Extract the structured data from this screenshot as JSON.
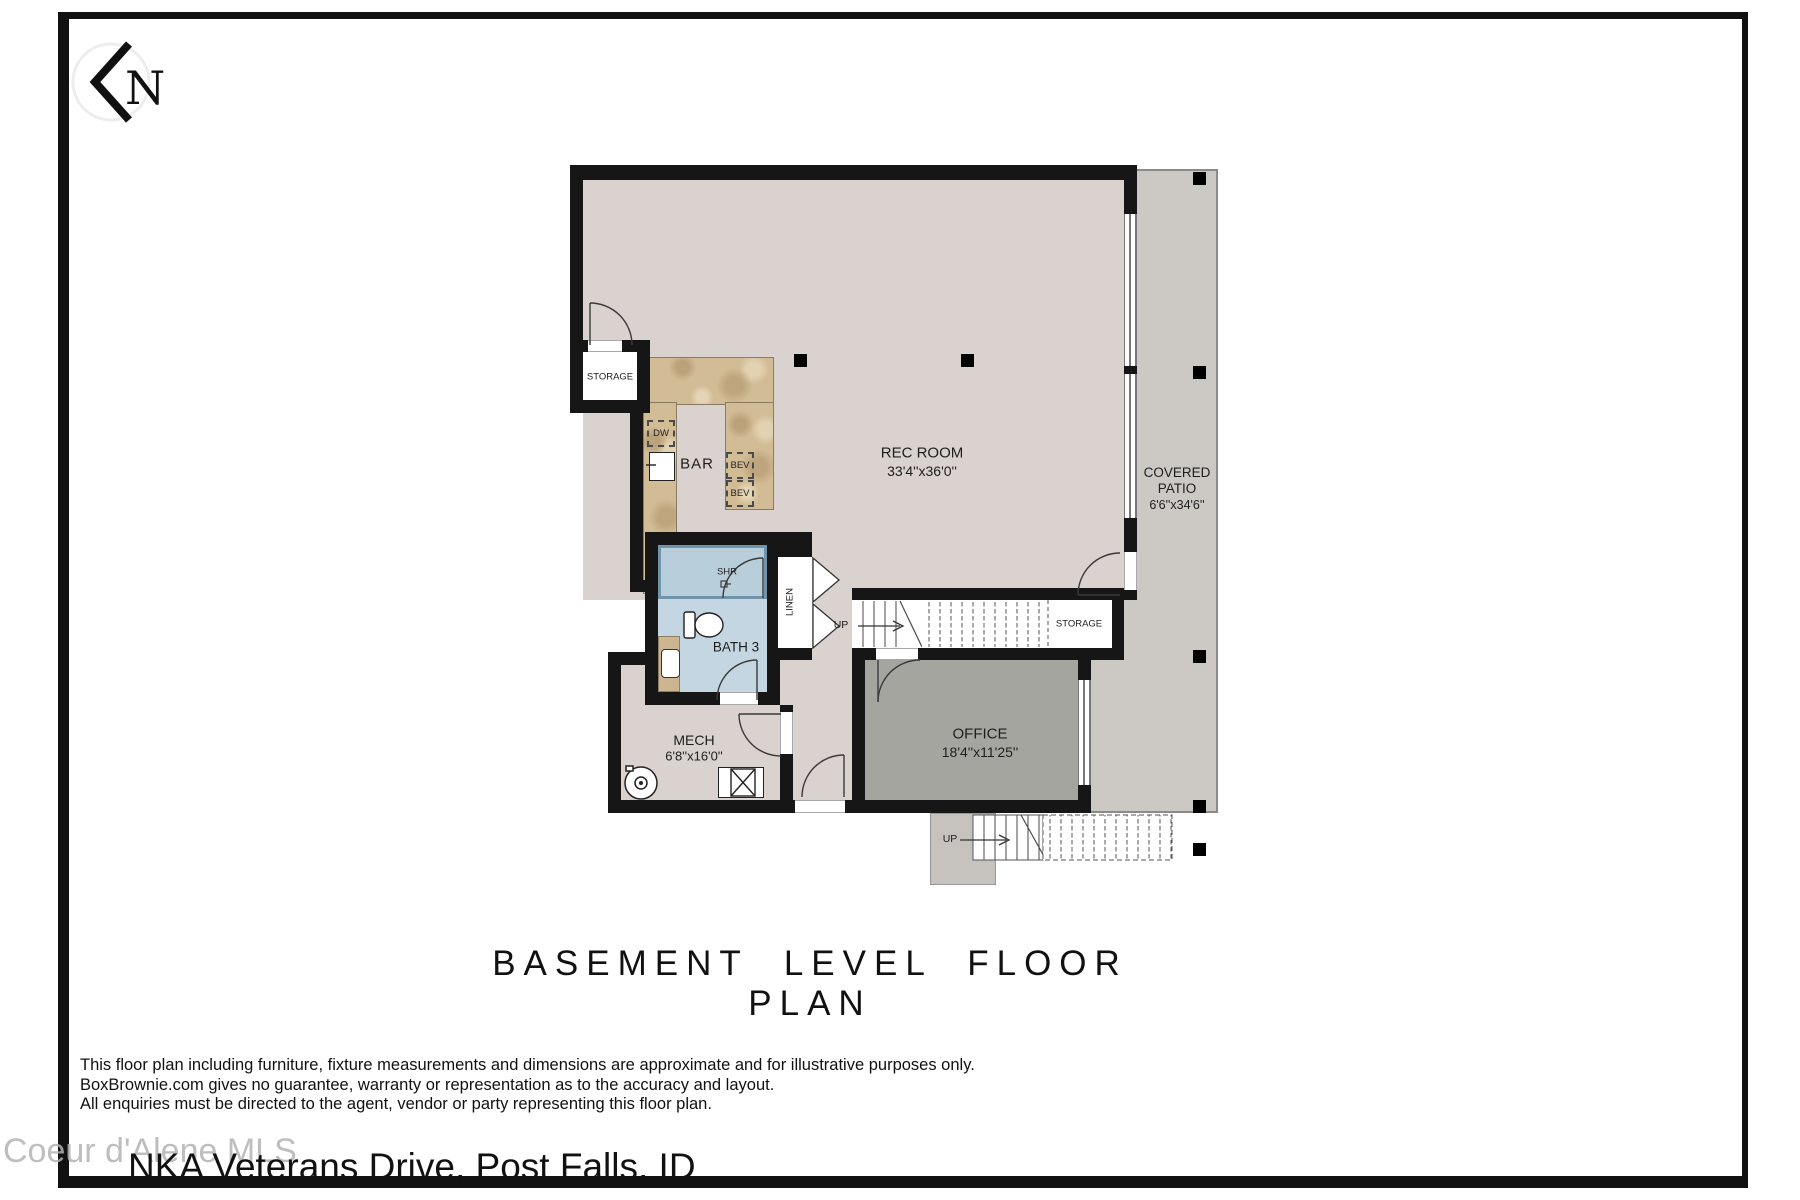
{
  "north": {
    "letter": "N"
  },
  "plan": {
    "title": "BASEMENT LEVEL FLOOR PLAN",
    "rooms": {
      "rec_room": {
        "name": "REC ROOM",
        "dims": "33'4''x36'0''"
      },
      "covered_patio": {
        "name": "COVERED PATIO",
        "dims": "6'6''x34'6''"
      },
      "office": {
        "name": "OFFICE",
        "dims": "18'4''x11'25''"
      },
      "mech": {
        "name": "MECH",
        "dims": "6'8''x16'0''"
      },
      "bath3": {
        "name": "BATH 3"
      },
      "bar": {
        "name": "BAR"
      },
      "storage_upper": {
        "name": "STORAGE"
      },
      "storage_under_stairs": {
        "name": "STORAGE"
      },
      "linen": {
        "name": "LINEN"
      },
      "shower": {
        "name": "SHR"
      }
    },
    "fixtures": {
      "dishwasher": "DW",
      "beverage1": "BEV",
      "beverage2": "BEV"
    },
    "stairs": {
      "up_main": "UP",
      "up_exterior": "UP"
    }
  },
  "footer": {
    "disclaimer": [
      "This floor plan including furniture, fixture measurements and dimensions are approximate and for illustrative purposes only.",
      "BoxBrownie.com gives no guarantee, warranty or representation as to the accuracy and layout.",
      "All enquiries must be directed to the agent, vendor or party representing this floor plan."
    ],
    "watermark": "Coeur d'Alene MLS",
    "address": "NKA Veterans Drive, Post Falls, ID"
  },
  "colors": {
    "wall": "#161616",
    "floor_main": "#d9d2ce",
    "floor_office": "#a5a5a0",
    "floor_patio": "#ccc9c5",
    "floor_bath": "#c3d6e2",
    "bar_counter": "#d2bc96"
  }
}
